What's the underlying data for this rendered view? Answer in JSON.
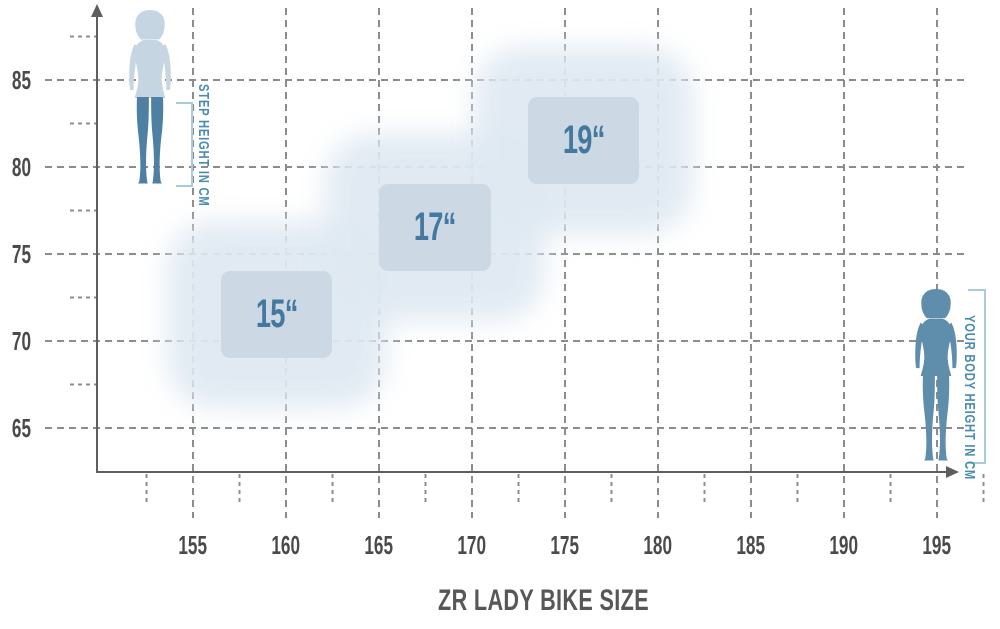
{
  "title": "ZR LADY BIKE SIZE",
  "annotations": {
    "step_height_label": "STEP HEIGHT IN CM",
    "body_height_label": "YOUR BODY HEIGHT IN CM"
  },
  "colors": {
    "figure_light": "#c6d5e2",
    "figure_dark": "#4d80a2",
    "figure_solid": "#5f8dac",
    "bracket": "#a9ccdd",
    "side_label": "#4a8cb0",
    "box_fill": "#ccd9e5",
    "box_halo": "#dfe9f2",
    "box_label": "#44789f",
    "grid": "#8c8c8c",
    "axis": "#5e5e5e",
    "tick_label": "#4a4a4a",
    "title": "#575757",
    "background": "#ffffff"
  },
  "chart_data": {
    "type": "scatter",
    "title": "ZR LADY BIKE SIZE",
    "xlabel": "YOUR BODY HEIGHT IN CM",
    "ylabel": "STEP HEIGHT IN CM",
    "x_ticks": [
      155,
      160,
      165,
      170,
      175,
      180,
      185,
      190,
      195
    ],
    "x_minor_ticks": [
      152.5,
      157.5,
      162.5,
      167.5,
      172.5,
      177.5,
      182.5,
      187.5,
      192.5,
      197.5
    ],
    "y_ticks": [
      65,
      70,
      75,
      80,
      85
    ],
    "y_minor_ticks": [
      67.5,
      72.5,
      77.5,
      82.5,
      87.5
    ],
    "xlim": [
      150,
      197.5
    ],
    "ylim": [
      62.5,
      88.5
    ],
    "grid": "dashed",
    "legend_position": "none",
    "regions": [
      {
        "label": "15“",
        "body_height_cm": [
          156.5,
          162.5
        ],
        "step_height_cm": [
          69,
          74
        ]
      },
      {
        "label": "17“",
        "body_height_cm": [
          165,
          171
        ],
        "step_height_cm": [
          74,
          79
        ]
      },
      {
        "label": "19“",
        "body_height_cm": [
          173,
          179
        ],
        "step_height_cm": [
          79,
          84
        ]
      }
    ]
  }
}
